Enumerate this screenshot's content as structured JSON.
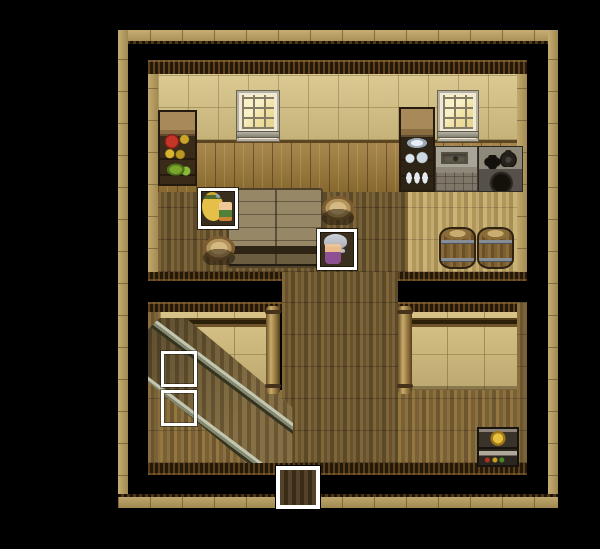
{
  "meta": {
    "scene_name": "wooden-house-interior-map",
    "canvas": {
      "width": 600,
      "height": 549
    },
    "style": "top-down rpg tile map on black backdrop"
  },
  "palette": {
    "backdrop": "#000000",
    "outer_wall_tan": "#b49a5e",
    "ceiling_trim_dark": "#241808",
    "wall_cream": "#d2c18a",
    "wall_wood_panel": "#97783f",
    "low_wall_tan": "#cdb97e",
    "floor_dark_planks": "#6f5933",
    "floor_pale_planks": "#c0a567",
    "floor_lower_planks": "#866c3c",
    "highlight_frame": "#ffffff",
    "elder_dress_purple": "#8d5093",
    "hero_hair_blonde": "#e4c048"
  },
  "characters": [
    {
      "id": "villager-blonde",
      "description": "blonde long-haired villager with green headband, facing right",
      "highlighted": true
    },
    {
      "id": "elder-woman",
      "description": "grey-haired elder woman in purple dress, facing left",
      "highlighted": true
    }
  ],
  "scene": {
    "layers": [
      {
        "name": "outer-wall-top",
        "type": "wall-h-top",
        "x": 118,
        "y": 30,
        "w": 440,
        "h": 14,
        "interactable": false
      },
      {
        "name": "outer-wall-left",
        "type": "wall-v",
        "x": 118,
        "y": 30,
        "w": 10,
        "h": 478,
        "interactable": false
      },
      {
        "name": "outer-wall-right",
        "type": "wall-v",
        "x": 548,
        "y": 30,
        "w": 10,
        "h": 478,
        "interactable": false
      },
      {
        "name": "outer-wall-bottom",
        "type": "wall-h-bottom",
        "x": 118,
        "y": 494,
        "w": 440,
        "h": 14,
        "interactable": false
      },
      {
        "name": "upper-room-ceiling-trim",
        "type": "trim",
        "x": 148,
        "y": 60,
        "w": 379,
        "h": 14,
        "interactable": false
      },
      {
        "name": "upper-room-frame-left",
        "type": "frame-tan",
        "x": 148,
        "y": 74,
        "w": 10,
        "h": 207,
        "interactable": false
      },
      {
        "name": "upper-room-frame-right",
        "type": "frame-tan",
        "x": 517,
        "y": 74,
        "w": 10,
        "h": 207,
        "interactable": false
      },
      {
        "name": "upper-room-wall-cream",
        "type": "wall-cream",
        "x": 158,
        "y": 74,
        "w": 359,
        "h": 66,
        "interactable": false
      },
      {
        "name": "upper-room-wall-panel",
        "type": "wall-panel",
        "x": 158,
        "y": 140,
        "w": 359,
        "h": 52,
        "interactable": false
      },
      {
        "name": "upper-room-floor-left",
        "type": "floor-dark",
        "x": 158,
        "y": 192,
        "w": 250,
        "h": 80,
        "interactable": false
      },
      {
        "name": "upper-room-floor-right",
        "type": "floor-pale",
        "x": 408,
        "y": 192,
        "w": 109,
        "h": 80,
        "interactable": false
      },
      {
        "name": "upper-room-edge-left",
        "type": "trim-b",
        "x": 148,
        "y": 272,
        "w": 134,
        "h": 9,
        "interactable": false
      },
      {
        "name": "upper-room-edge-right",
        "type": "trim-b",
        "x": 398,
        "y": 272,
        "w": 129,
        "h": 9,
        "interactable": false
      },
      {
        "name": "corridor-floor",
        "type": "floor-dark",
        "x": 282,
        "y": 272,
        "w": 116,
        "h": 191,
        "interactable": false
      },
      {
        "name": "lower-left-ceiling-trim",
        "type": "trim",
        "x": 148,
        "y": 302,
        "w": 134,
        "h": 10,
        "interactable": false
      },
      {
        "name": "lower-left-frame",
        "type": "frame-plank",
        "x": 148,
        "y": 312,
        "w": 12,
        "h": 151,
        "interactable": false
      },
      {
        "name": "lower-left-wall",
        "type": "wall-tan",
        "x": 160,
        "y": 312,
        "w": 108,
        "h": 78,
        "interactable": false
      },
      {
        "name": "lower-left-floor",
        "type": "floor-low",
        "x": 160,
        "y": 390,
        "w": 122,
        "h": 73,
        "interactable": false
      },
      {
        "name": "lower-right-ceiling-trim",
        "type": "trim",
        "x": 398,
        "y": 302,
        "w": 129,
        "h": 10,
        "interactable": false
      },
      {
        "name": "lower-right-wall",
        "type": "wall-tan",
        "x": 410,
        "y": 312,
        "w": 107,
        "h": 78,
        "interactable": false
      },
      {
        "name": "lower-right-floor",
        "type": "floor-low",
        "x": 398,
        "y": 390,
        "w": 129,
        "h": 73,
        "interactable": false
      },
      {
        "name": "lower-right-frame",
        "type": "frame-plank",
        "x": 517,
        "y": 302,
        "w": 10,
        "h": 161,
        "interactable": false
      },
      {
        "name": "floor-bottom-edge",
        "type": "trim-b",
        "x": 148,
        "y": 463,
        "w": 379,
        "h": 12,
        "interactable": false
      },
      {
        "name": "staircase",
        "type": "stairs",
        "x": 148,
        "y": 318,
        "w": 145,
        "h": 145,
        "interactable": true
      },
      {
        "name": "pillar-left",
        "type": "pillar",
        "x": 266,
        "y": 306,
        "w": 14,
        "h": 88,
        "interactable": false
      },
      {
        "name": "pillar-right",
        "type": "pillar",
        "x": 398,
        "y": 306,
        "w": 14,
        "h": 88,
        "interactable": false
      },
      {
        "name": "food-shelf",
        "type": "shelf-food",
        "x": 158,
        "y": 110,
        "w": 39,
        "h": 76,
        "interactable": false
      },
      {
        "name": "window-left",
        "type": "window",
        "x": 237,
        "y": 91,
        "w": 42,
        "h": 50,
        "interactable": false
      },
      {
        "name": "window-right",
        "type": "window",
        "x": 438,
        "y": 91,
        "w": 40,
        "h": 50,
        "interactable": false
      },
      {
        "name": "dish-cupboard",
        "type": "cupboard",
        "x": 399,
        "y": 107,
        "w": 36,
        "h": 85,
        "interactable": false
      },
      {
        "name": "kitchen-counter-sink",
        "type": "counter",
        "x": 435,
        "y": 146,
        "w": 43,
        "h": 46,
        "interactable": false
      },
      {
        "name": "kitchen-stove",
        "type": "stove",
        "x": 478,
        "y": 146,
        "w": 45,
        "h": 46,
        "interactable": false
      },
      {
        "name": "dining-table",
        "type": "table",
        "x": 227,
        "y": 188,
        "w": 96,
        "h": 80,
        "interactable": false
      },
      {
        "name": "stool-left",
        "type": "stool",
        "x": 202,
        "y": 236,
        "w": 34,
        "h": 29,
        "interactable": false
      },
      {
        "name": "stool-right",
        "type": "stool",
        "x": 321,
        "y": 196,
        "w": 34,
        "h": 29,
        "interactable": false
      },
      {
        "name": "barrel-left",
        "type": "barrel",
        "x": 439,
        "y": 227,
        "w": 37,
        "h": 42,
        "interactable": false
      },
      {
        "name": "barrel-right",
        "type": "barrel",
        "x": 477,
        "y": 227,
        "w": 37,
        "h": 42,
        "interactable": false
      },
      {
        "name": "storage-workbench",
        "type": "toolbox",
        "x": 477,
        "y": 427,
        "w": 42,
        "h": 40,
        "interactable": false
      },
      {
        "name": "npc-villager-blonde",
        "type": "char char-blonde",
        "x": 198,
        "y": 188,
        "w": 40,
        "h": 41,
        "interactable": true
      },
      {
        "name": "npc-elder-woman",
        "type": "char char-elder",
        "x": 317,
        "y": 229,
        "w": 40,
        "h": 41,
        "interactable": true
      },
      {
        "name": "event-marker-stairs-upper",
        "type": "marker",
        "x": 161,
        "y": 351,
        "w": 36,
        "h": 36,
        "interactable": true
      },
      {
        "name": "event-marker-stairs-lower",
        "type": "marker",
        "x": 161,
        "y": 390,
        "w": 36,
        "h": 36,
        "interactable": true
      },
      {
        "name": "exit-door",
        "type": "door",
        "x": 276,
        "y": 466,
        "w": 44,
        "h": 43,
        "interactable": true
      }
    ]
  }
}
